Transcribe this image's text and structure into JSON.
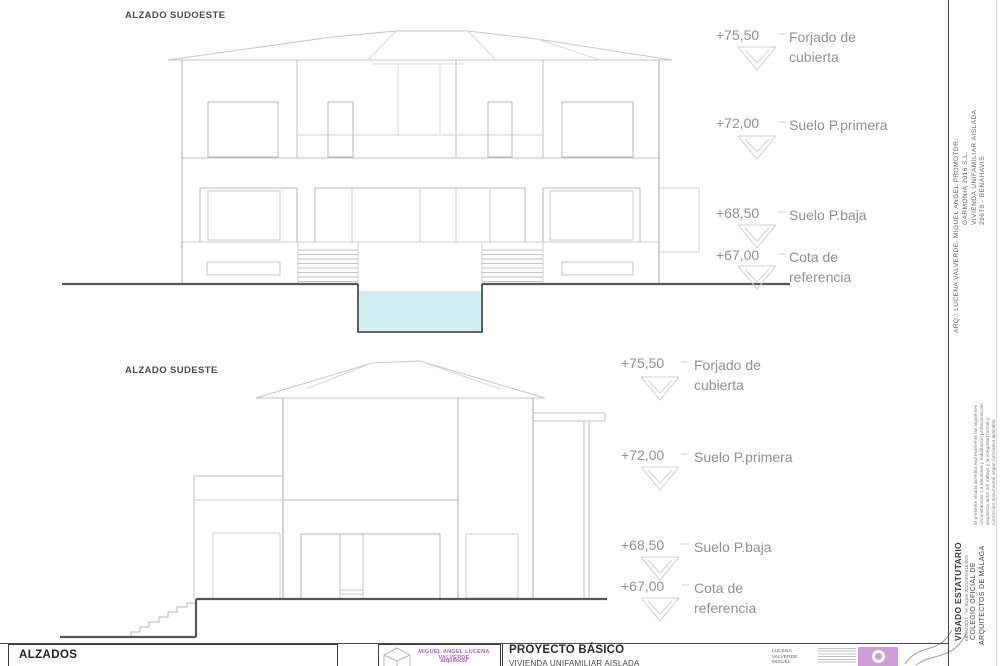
{
  "drawings": {
    "southwest": {
      "title": "ALZADO SUDOESTE"
    },
    "southeast": {
      "title": "ALZADO SUDESTE"
    }
  },
  "levels": [
    {
      "value": "+75,50",
      "label1": "Forjado de",
      "label2": "cubierta"
    },
    {
      "value": "+72,00",
      "label1": "Suelo P.primera",
      "label2": ""
    },
    {
      "value": "+68,50",
      "label1": "Suelo P.baja",
      "label2": ""
    },
    {
      "value": "+67,00",
      "label1": "Cota de",
      "label2": "referencia"
    }
  ],
  "titleblock": {
    "sheet_title": "ALZADOS",
    "stamp": {
      "architect_name": "MIGUEL ANGEL LUCENA VALVERDE",
      "architect_role": "arquitecto"
    },
    "project": {
      "type": "PROYECTO BÁSICO",
      "name": "VIVIENDA UNIFAMILIAR AISLADA"
    },
    "signer": {
      "line1": "LUCENA",
      "line2": "VALVERDE",
      "line3": "MIGUEL"
    }
  },
  "margin": {
    "arq_line": "ARQ.: LUCENA VALVERDE, MIGUEL ANGEL    PROMOTOR:",
    "promoter_lines": [
      "GARMONIA 2016 S.L.",
      "VIVIENDA UNIFAMILIAR AISLADA",
      "29679 - BENAHAVIS"
    ],
    "visado": {
      "title": "VISADO ESTATUTARIO",
      "expediente": "08/06/2021 - Nº Expte 2021/001610/002",
      "org1": "COLEGIO OFICIAL DE",
      "org2": "ARQUITECTOS DE MÁLAGA",
      "fineprint_lines": [
        "El presente visado acredita expresamente las siguientes",
        "circunstancias: La identidad y habilitación profesional del",
        "arquitecto autor del trabajo y la integridad formal y",
        "corrección documental según normativa aplicable."
      ]
    }
  },
  "colors": {
    "water": "#d2eff6",
    "accent_purple": "#a965c3",
    "logo_pink": "#cf9ed8",
    "line_light": "#c0c0c0",
    "line_dark": "#4f4f4f",
    "text_gray": "#909090"
  }
}
